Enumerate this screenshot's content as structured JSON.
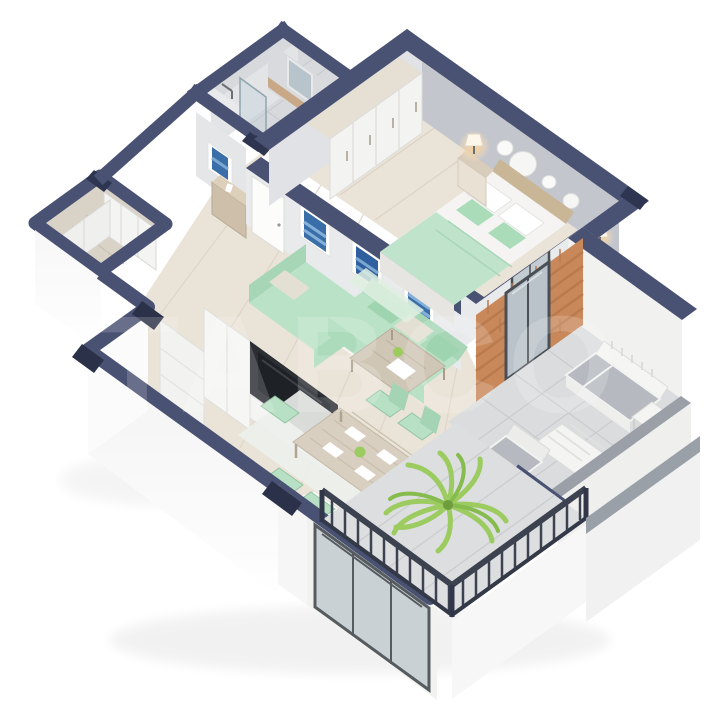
{
  "watermark": {
    "text": "TABCO"
  },
  "colors": {
    "background": "#ffffff",
    "wall_cut_navy": "#4a5273",
    "wall_cut_dark": "#2e3550",
    "interior_wall": "#e9eaec",
    "accent_wall_gray": "#c3c6cc",
    "wood_floor": "#eae3d7",
    "gray_wood_floor": "#d8d2c7",
    "tile_floor": "#dadcde",
    "mint_sofa": "#b9e2c6",
    "mint_dark": "#a6d6b6",
    "beige_pillow": "#e3e0d3",
    "wood_furniture": "#cfc6b5",
    "brick": "#c9885a",
    "glass": "#c3ccd1",
    "frame_dark": "#4a4f55",
    "outdoor_cushion": "#b6bac0",
    "parapet_cap": "#9ba0a8",
    "railing_dark": "#3d4250",
    "art_blue": "#3a6ea8",
    "lamp_glow": "#ffcf8e",
    "plant_green": "#9ccb5f"
  }
}
